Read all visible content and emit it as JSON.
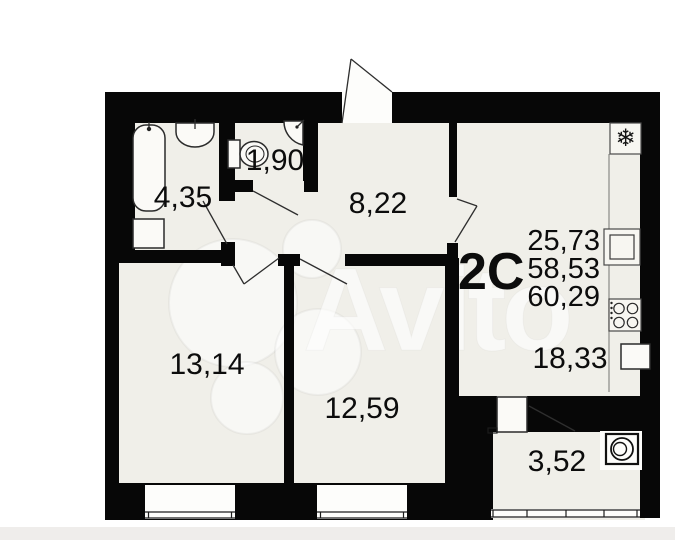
{
  "watermark": {
    "brand": "Avito"
  },
  "plan": {
    "type_label": "2С",
    "area_summary": {
      "line1": "25,73",
      "line2": "58,53",
      "line3": "60,29"
    },
    "rooms": [
      {
        "name": "bathroom",
        "area": "4,35"
      },
      {
        "name": "toilet",
        "area": "1,90"
      },
      {
        "name": "hallway",
        "area": "8,22"
      },
      {
        "name": "living-room-1",
        "area": "13,14"
      },
      {
        "name": "living-room-2",
        "area": "12,59"
      },
      {
        "name": "kitchen",
        "area": "18,33"
      },
      {
        "name": "loggia",
        "area": "3,52"
      }
    ],
    "icons": {
      "fridge_snowflake": "❄"
    },
    "colors": {
      "wall": "#070707",
      "floor": "#f0efe9",
      "text": "#0c0c0c",
      "page": "#ffffff"
    }
  }
}
